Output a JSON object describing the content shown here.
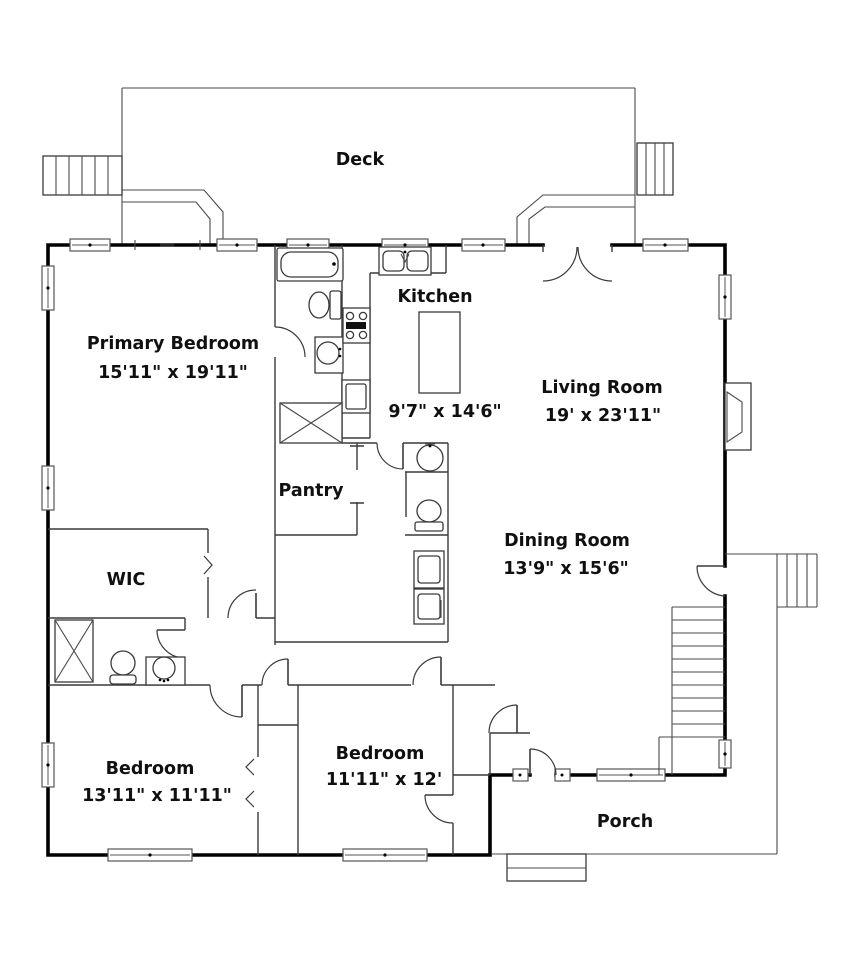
{
  "rooms": [
    {
      "name": "Deck"
    },
    {
      "name": "Primary Bedroom",
      "dims": "15'11\" x 19'11\""
    },
    {
      "name": "Kitchen",
      "dims": "9'7\" x 14'6\""
    },
    {
      "name": "Living Room",
      "dims": "19' x 23'11\""
    },
    {
      "name": "Pantry"
    },
    {
      "name": "Dining Room",
      "dims": "13'9\" x 15'6\""
    },
    {
      "name": "WIC"
    },
    {
      "name": "Bedroom",
      "dims": "13'11\" x 11'11\""
    },
    {
      "name": "Bedroom",
      "dims": "11'11\" x 12'"
    },
    {
      "name": "Porch"
    }
  ],
  "colors": {
    "wall": "#000000",
    "line": "#3a3a3a",
    "text": "#101010",
    "background": "#ffffff"
  },
  "fixtures": [
    "bathtub",
    "toilet",
    "sink",
    "shower",
    "stove",
    "dishwasher",
    "kitchen-sink",
    "kitchen-island",
    "washer-dryer",
    "pantry-shelves",
    "closet-doors",
    "fireplace",
    "interior-stairs",
    "deck-stairs",
    "exterior-stairs",
    "porch-steps",
    "windows",
    "doors"
  ]
}
